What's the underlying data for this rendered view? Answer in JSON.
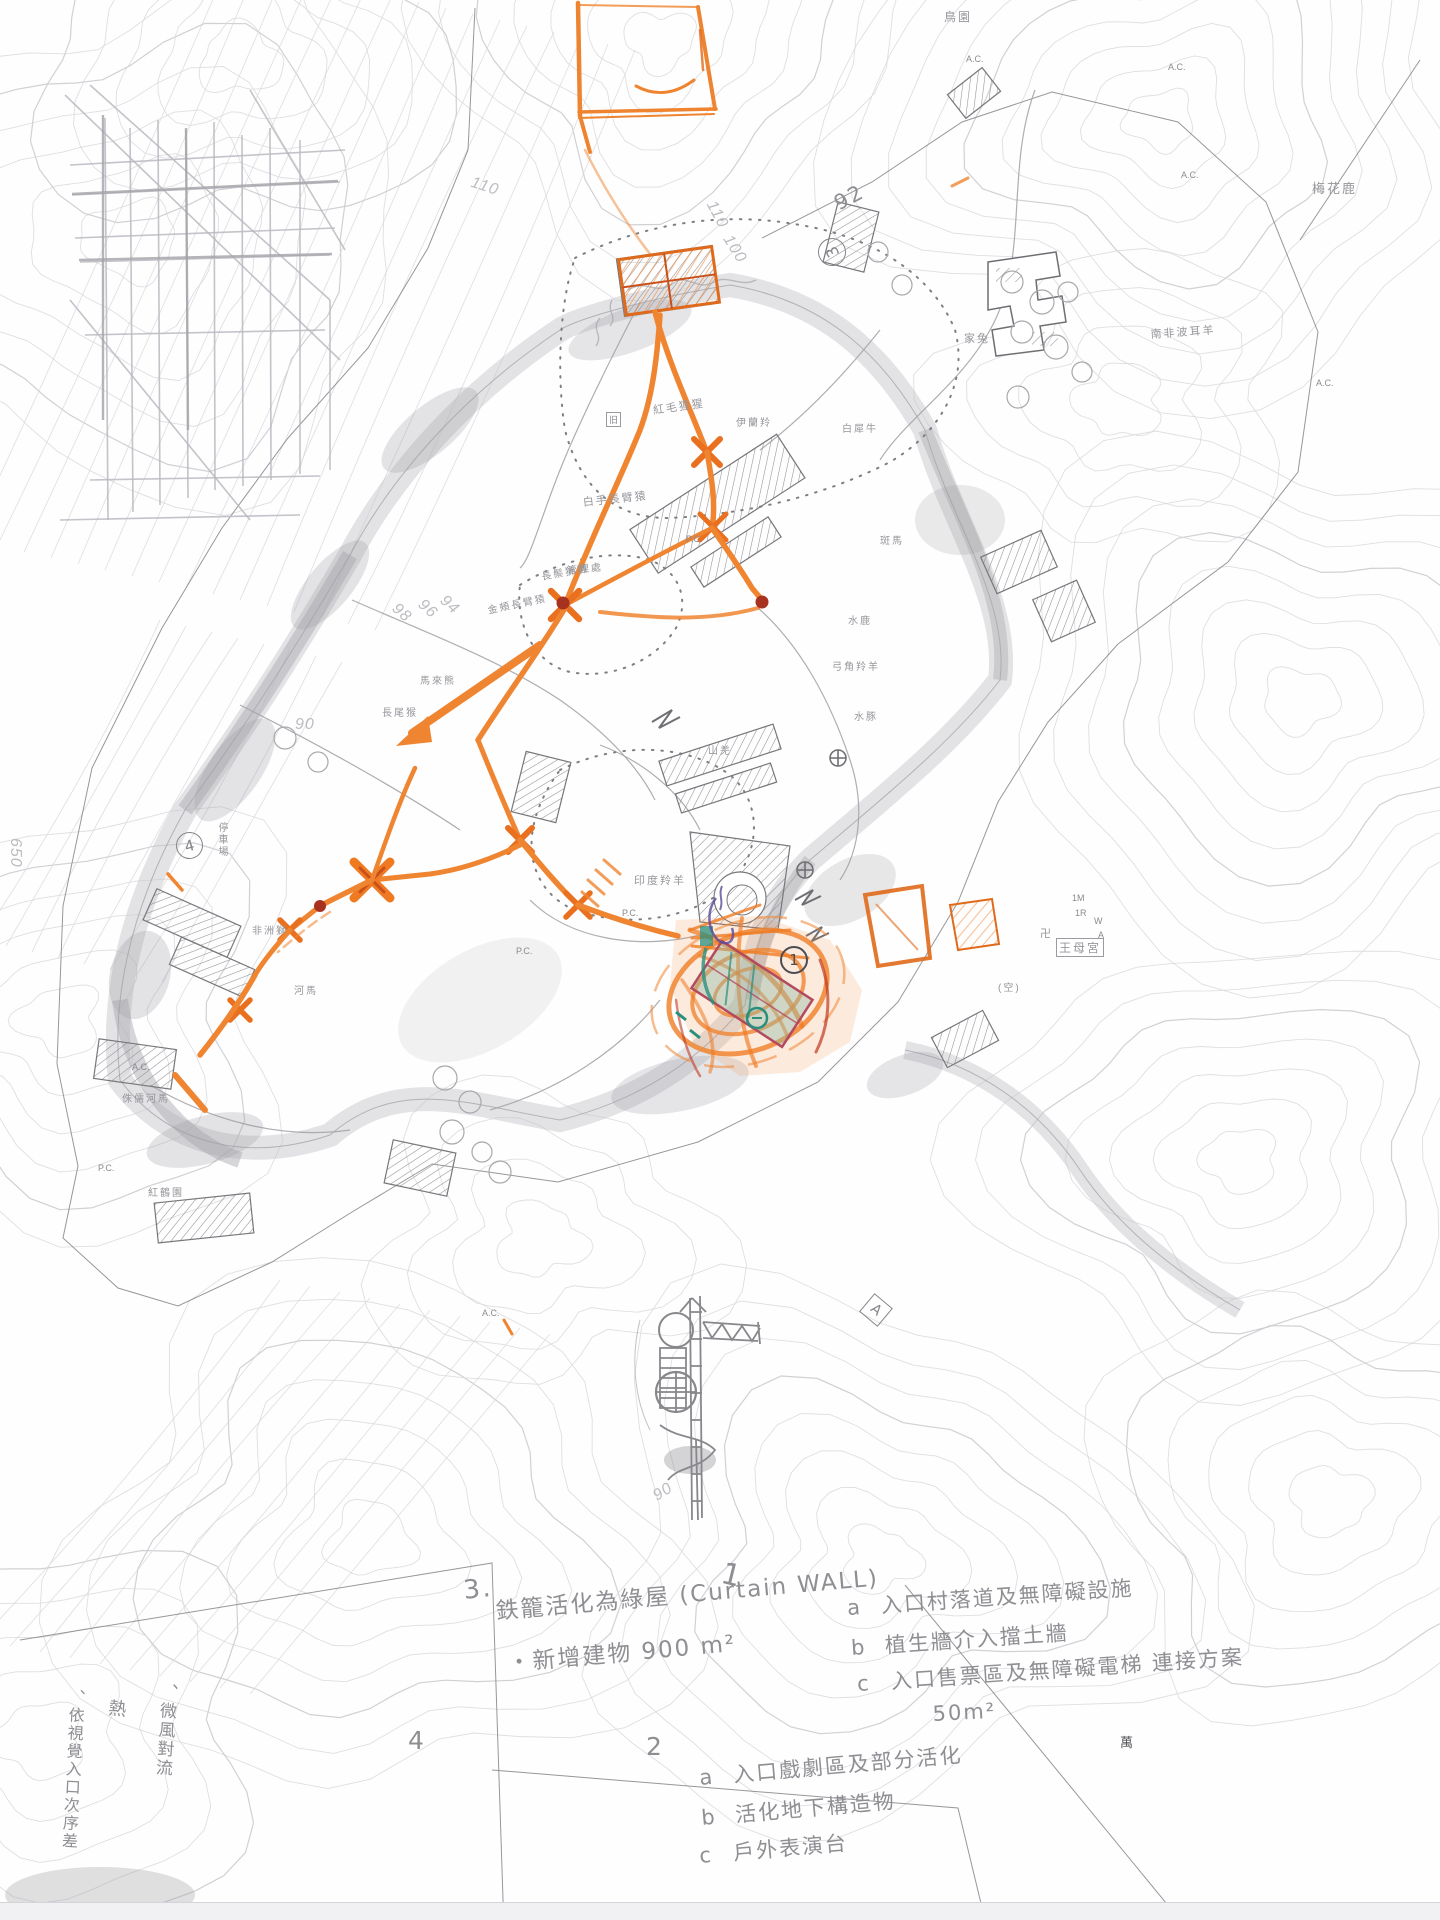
{
  "notes": {
    "n1": "1",
    "n3num": "3.",
    "note3_line1": "鉄籠活化為綠屋 (Curtain WALL)",
    "note3_line2": "・新增建物 900 m²",
    "list1": {
      "items": [
        {
          "key": "a",
          "text": "入口村落道及無障礙設施"
        },
        {
          "key": "b",
          "text": "植生牆介入擋土牆"
        },
        {
          "key": "c",
          "text": "入口售票區及無障礙電梯 連接方案"
        }
      ],
      "area": "50m²"
    },
    "n4": "4",
    "list2": {
      "num": "2",
      "items": [
        {
          "key": "a",
          "text": "入口戲劇區及部分活化"
        },
        {
          "key": "b",
          "text": "活化地下構造物"
        },
        {
          "key": "c",
          "text": "戶外表演台"
        }
      ]
    },
    "left": [
      "、微風對流",
      "熱",
      "、依視覺入口次序差"
    ],
    "wan": "萬"
  },
  "ann": {
    "n92": "92",
    "c3": "3",
    "c4": "4",
    "c1": "1",
    "boxA": "A"
  },
  "map_labels": [
    {
      "t": "鳥園",
      "x": 944,
      "y": 8,
      "s": 12,
      "n": "label-bird-garden"
    },
    {
      "t": "梅花鹿",
      "x": 1312,
      "y": 178,
      "s": 13,
      "n": "label-sika-deer"
    },
    {
      "t": "家兔",
      "x": 964,
      "y": 330,
      "s": 11,
      "n": "label-rabbit"
    },
    {
      "t": "南非波耳羊",
      "x": 1150,
      "y": 326,
      "s": 11,
      "r": -4,
      "n": "label-boer-goat"
    },
    {
      "t": "紅毛猩猩",
      "x": 652,
      "y": 402,
      "s": 11,
      "r": -8,
      "n": "label-orangutan"
    },
    {
      "t": "白手長臂猿",
      "x": 582,
      "y": 494,
      "s": 11,
      "r": -6,
      "n": "label-gibbon"
    },
    {
      "t": "伊蘭羚",
      "x": 736,
      "y": 414,
      "s": 10,
      "n": "label-eland"
    },
    {
      "t": "白犀牛",
      "x": 842,
      "y": 420,
      "s": 10,
      "n": "label-white-rhino"
    },
    {
      "t": "長鬃狒狒",
      "x": 540,
      "y": 568,
      "s": 10,
      "r": -10,
      "n": "label-baboon"
    },
    {
      "t": "金頰長臂猿",
      "x": 486,
      "y": 602,
      "s": 10,
      "r": -12,
      "n": "label-gibbon-2"
    },
    {
      "t": "馬來熊",
      "x": 420,
      "y": 672,
      "s": 10,
      "n": "label-sun-bear"
    },
    {
      "t": "長尾猴",
      "x": 382,
      "y": 704,
      "s": 10,
      "n": "label-monkey"
    },
    {
      "t": "管理處",
      "x": 566,
      "y": 562,
      "s": 10,
      "r": -6,
      "n": "label-admin"
    },
    {
      "t": "印度羚羊",
      "x": 634,
      "y": 872,
      "s": 11,
      "n": "label-indian-antelope"
    },
    {
      "t": "山羌",
      "x": 708,
      "y": 742,
      "s": 10,
      "n": "label-muntjac"
    },
    {
      "t": "水鹿",
      "x": 848,
      "y": 612,
      "s": 10,
      "n": "label-sambar"
    },
    {
      "t": "斑馬",
      "x": 880,
      "y": 532,
      "s": 10,
      "n": "label-zebra"
    },
    {
      "t": "弓角羚羊",
      "x": 832,
      "y": 658,
      "s": 10,
      "n": "label-addax"
    },
    {
      "t": "水豚",
      "x": 854,
      "y": 708,
      "s": 10,
      "n": "label-capybara"
    },
    {
      "t": "非洲獅",
      "x": 252,
      "y": 922,
      "s": 10,
      "n": "label-lion"
    },
    {
      "t": "河馬",
      "x": 294,
      "y": 982,
      "s": 10,
      "n": "label-hippo"
    },
    {
      "t": "侏儒河馬",
      "x": 122,
      "y": 1090,
      "s": 10,
      "n": "label-pygmy-hippo"
    },
    {
      "t": "紅鶴園",
      "x": 148,
      "y": 1184,
      "s": 10,
      "n": "label-flamingo"
    },
    {
      "t": "停車場",
      "x": 214,
      "y": 822,
      "s": 10,
      "v": 1,
      "n": "label-parking"
    },
    {
      "t": "王母宮",
      "x": 1056,
      "y": 938,
      "s": 12,
      "cls": "boxed",
      "n": "label-temple"
    },
    {
      "t": "卍",
      "x": 1040,
      "y": 925,
      "s": 11,
      "n": "temple-icon"
    },
    {
      "t": "(空)",
      "x": 998,
      "y": 979,
      "s": 10
    },
    {
      "t": "1M",
      "x": 1072,
      "y": 893,
      "cls": "tiny"
    },
    {
      "t": "1R",
      "x": 1075,
      "y": 908,
      "cls": "tiny"
    },
    {
      "t": "W",
      "x": 1094,
      "y": 916,
      "cls": "tiny"
    },
    {
      "t": "A",
      "x": 1098,
      "y": 930,
      "cls": "tiny"
    },
    {
      "t": "旧",
      "x": 606,
      "y": 412,
      "cls": "tiny boxed"
    },
    {
      "t": "A.C.",
      "x": 1168,
      "y": 62,
      "cls": "tiny"
    },
    {
      "t": "A.C.",
      "x": 1181,
      "y": 170,
      "cls": "tiny"
    },
    {
      "t": "A.C.",
      "x": 1316,
      "y": 378,
      "cls": "tiny"
    },
    {
      "t": "A.C.",
      "x": 482,
      "y": 1308,
      "cls": "tiny"
    },
    {
      "t": "A.C.",
      "x": 132,
      "y": 1062,
      "cls": "tiny"
    },
    {
      "t": "A.C.",
      "x": 966,
      "y": 54,
      "cls": "tiny"
    },
    {
      "t": "P.C.",
      "x": 686,
      "y": 534,
      "cls": "tiny"
    },
    {
      "t": "P.C.",
      "x": 622,
      "y": 908,
      "cls": "tiny"
    },
    {
      "t": "P.C.",
      "x": 98,
      "y": 1163,
      "cls": "tiny"
    },
    {
      "t": "P.C.",
      "x": 516,
      "y": 946,
      "cls": "tiny"
    },
    {
      "t": "110",
      "x": 474,
      "y": 174,
      "cls": "elev",
      "r": 18
    },
    {
      "t": "110",
      "x": 718,
      "y": 198,
      "cls": "elev",
      "r": 62
    },
    {
      "t": "100",
      "x": 734,
      "y": 232,
      "cls": "elev",
      "r": 58
    },
    {
      "t": "98",
      "x": 400,
      "y": 600,
      "cls": "elev",
      "r": 42
    },
    {
      "t": "96",
      "x": 426,
      "y": 596,
      "cls": "elev",
      "r": 42
    },
    {
      "t": "94",
      "x": 448,
      "y": 592,
      "cls": "elev",
      "r": 42
    },
    {
      "t": "90",
      "x": 295,
      "y": 716,
      "cls": "elev"
    },
    {
      "t": "90",
      "x": 650,
      "y": 1490,
      "cls": "elev",
      "r": -32
    },
    {
      "t": "650",
      "x": 6,
      "y": 838,
      "cls": "elev",
      "v": 1
    }
  ]
}
